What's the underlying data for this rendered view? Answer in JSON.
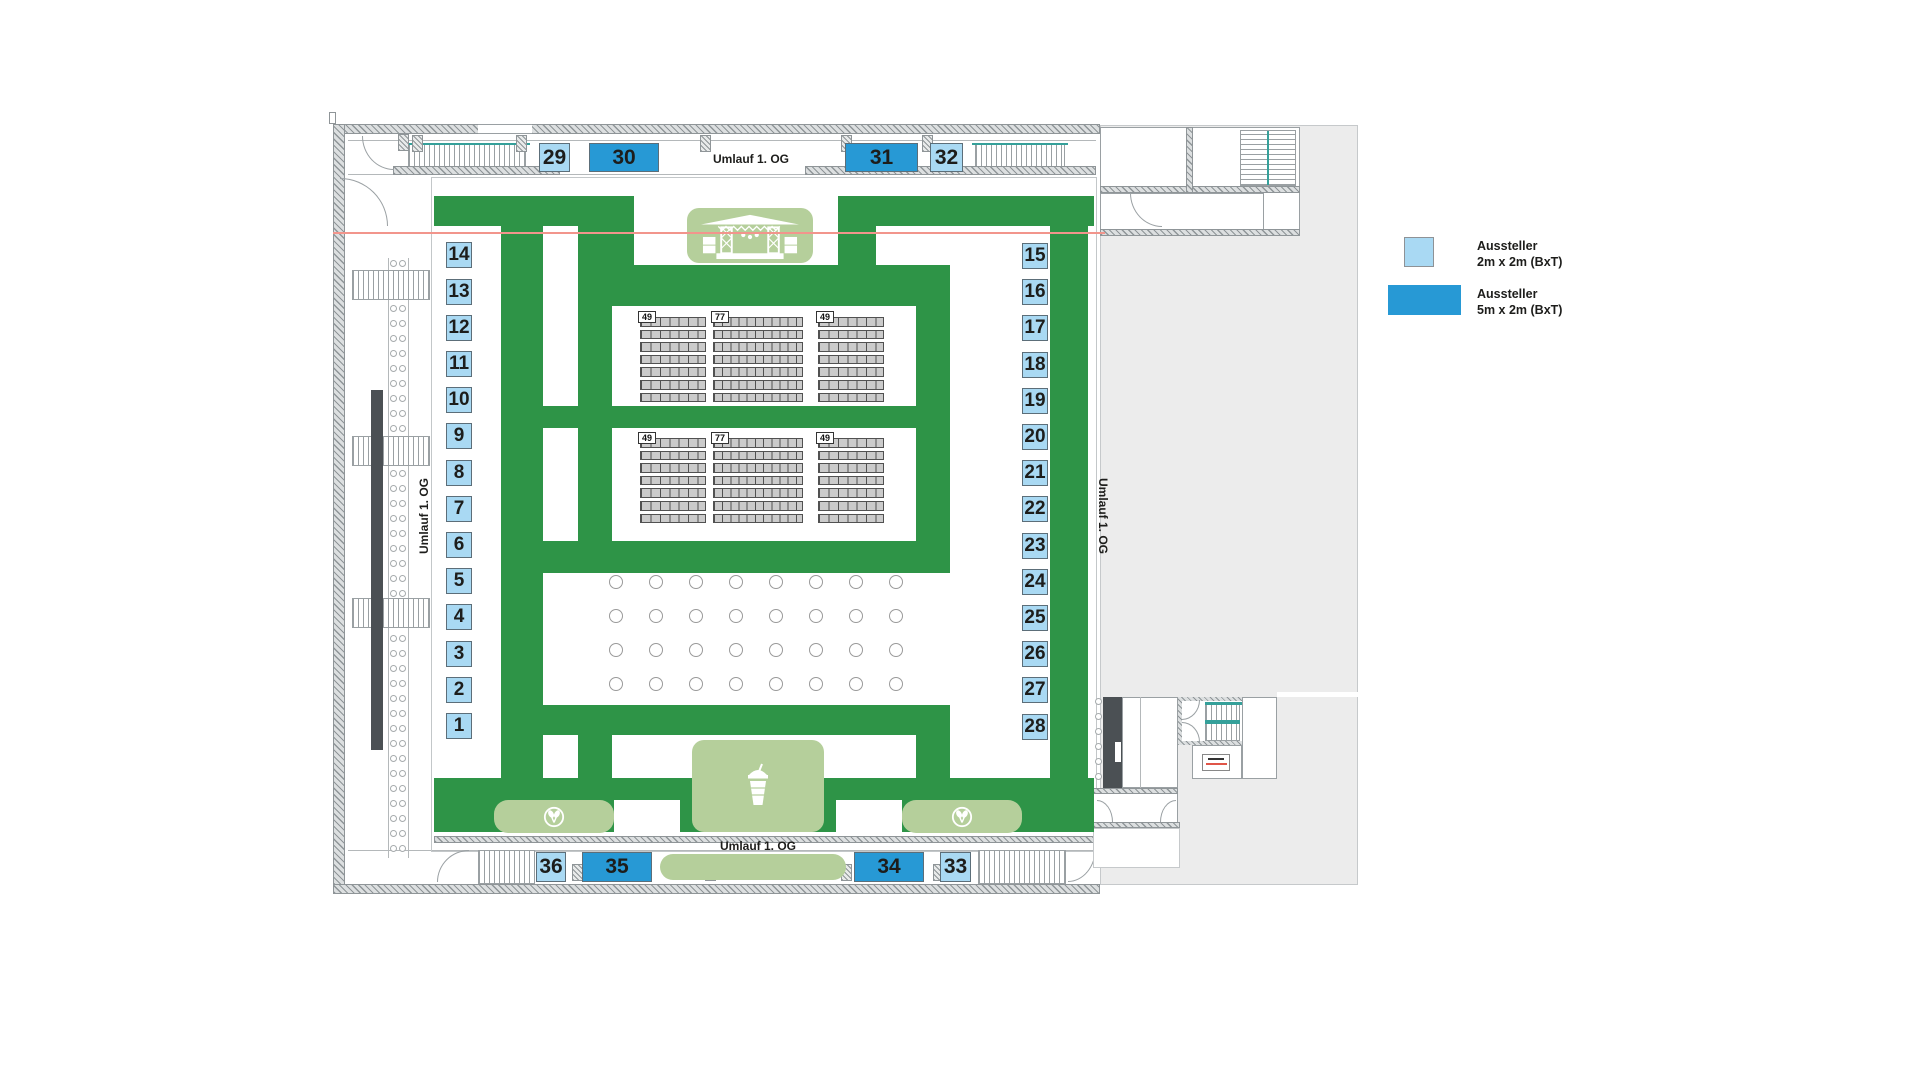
{
  "corridors": {
    "top": "Umlauf 1. OG",
    "bottom": "Umlauf 1. OG",
    "left": "Umlauf 1. OG",
    "right": "Umlauf 1. OG"
  },
  "booths": {
    "left": [
      "14",
      "13",
      "12",
      "11",
      "10",
      "9",
      "8",
      "7",
      "6",
      "5",
      "4",
      "3",
      "2",
      "1"
    ],
    "right": [
      "15",
      "16",
      "17",
      "18",
      "19",
      "20",
      "21",
      "22",
      "23",
      "24",
      "25",
      "26",
      "27",
      "28"
    ],
    "top": [
      "29",
      "30",
      "31",
      "32"
    ],
    "bottom": [
      "36",
      "35",
      "34",
      "33"
    ]
  },
  "seating": {
    "labels": [
      "49",
      "77",
      "49"
    ],
    "seats_per_row": [
      7,
      11,
      7
    ],
    "rows_per_block": 7,
    "groups": 2
  },
  "tables": {
    "rows": 4,
    "cols": 8
  },
  "legend": {
    "items": [
      {
        "line1": "Aussteller",
        "line2": "2m x 2m (BxT)",
        "color": "#a9d9f3"
      },
      {
        "line1": "Aussteller",
        "line2": "5m x 2m (BxT)",
        "color": "#2799d5"
      }
    ]
  },
  "icons": {
    "stage": "stage-icon",
    "drink": "smoothie-cup-icon",
    "mask_left": "mask-icon",
    "mask_right": "mask-icon",
    "mask_bottom": "mask-icon"
  },
  "colors": {
    "walkway_green": "#2e9447",
    "area_light_green": "#b5cf9b",
    "booth_2m": "#a9d9f3",
    "booth_5m": "#2799d5",
    "seat_gray": "#cbcbcb",
    "accent_red_line": "#f2958c",
    "stair_teal": "#35a09a",
    "background_gray": "#ececec"
  }
}
